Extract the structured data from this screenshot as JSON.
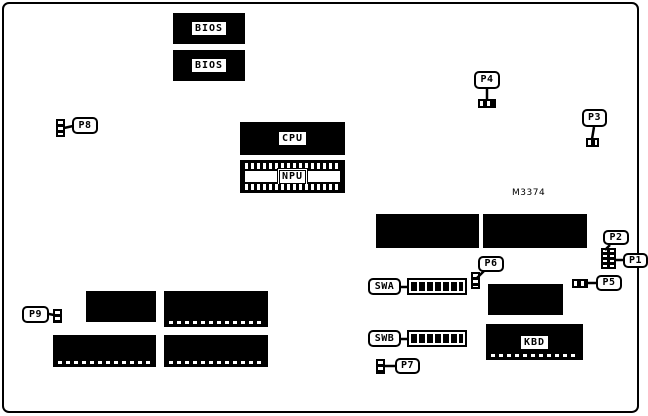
{
  "diagram": {
    "kind": "motherboard-component-location-diagram",
    "colors": {
      "background": "#ffffff",
      "ink": "#000000"
    },
    "chips": {
      "bios1": "BIOS",
      "bios2": "BIOS",
      "cpu": "CPU",
      "npu": "NPU",
      "kbd": "KBD"
    },
    "connectors": {
      "p1": "P1",
      "p2": "P2",
      "p3": "P3",
      "p4": "P4",
      "p5": "P5",
      "p6": "P6",
      "p7": "P7",
      "p8": "P8",
      "p9": "P9"
    },
    "switches": {
      "swa": "SWA",
      "swb": "SWB"
    },
    "annotations": {
      "part_number": "M3374"
    }
  }
}
